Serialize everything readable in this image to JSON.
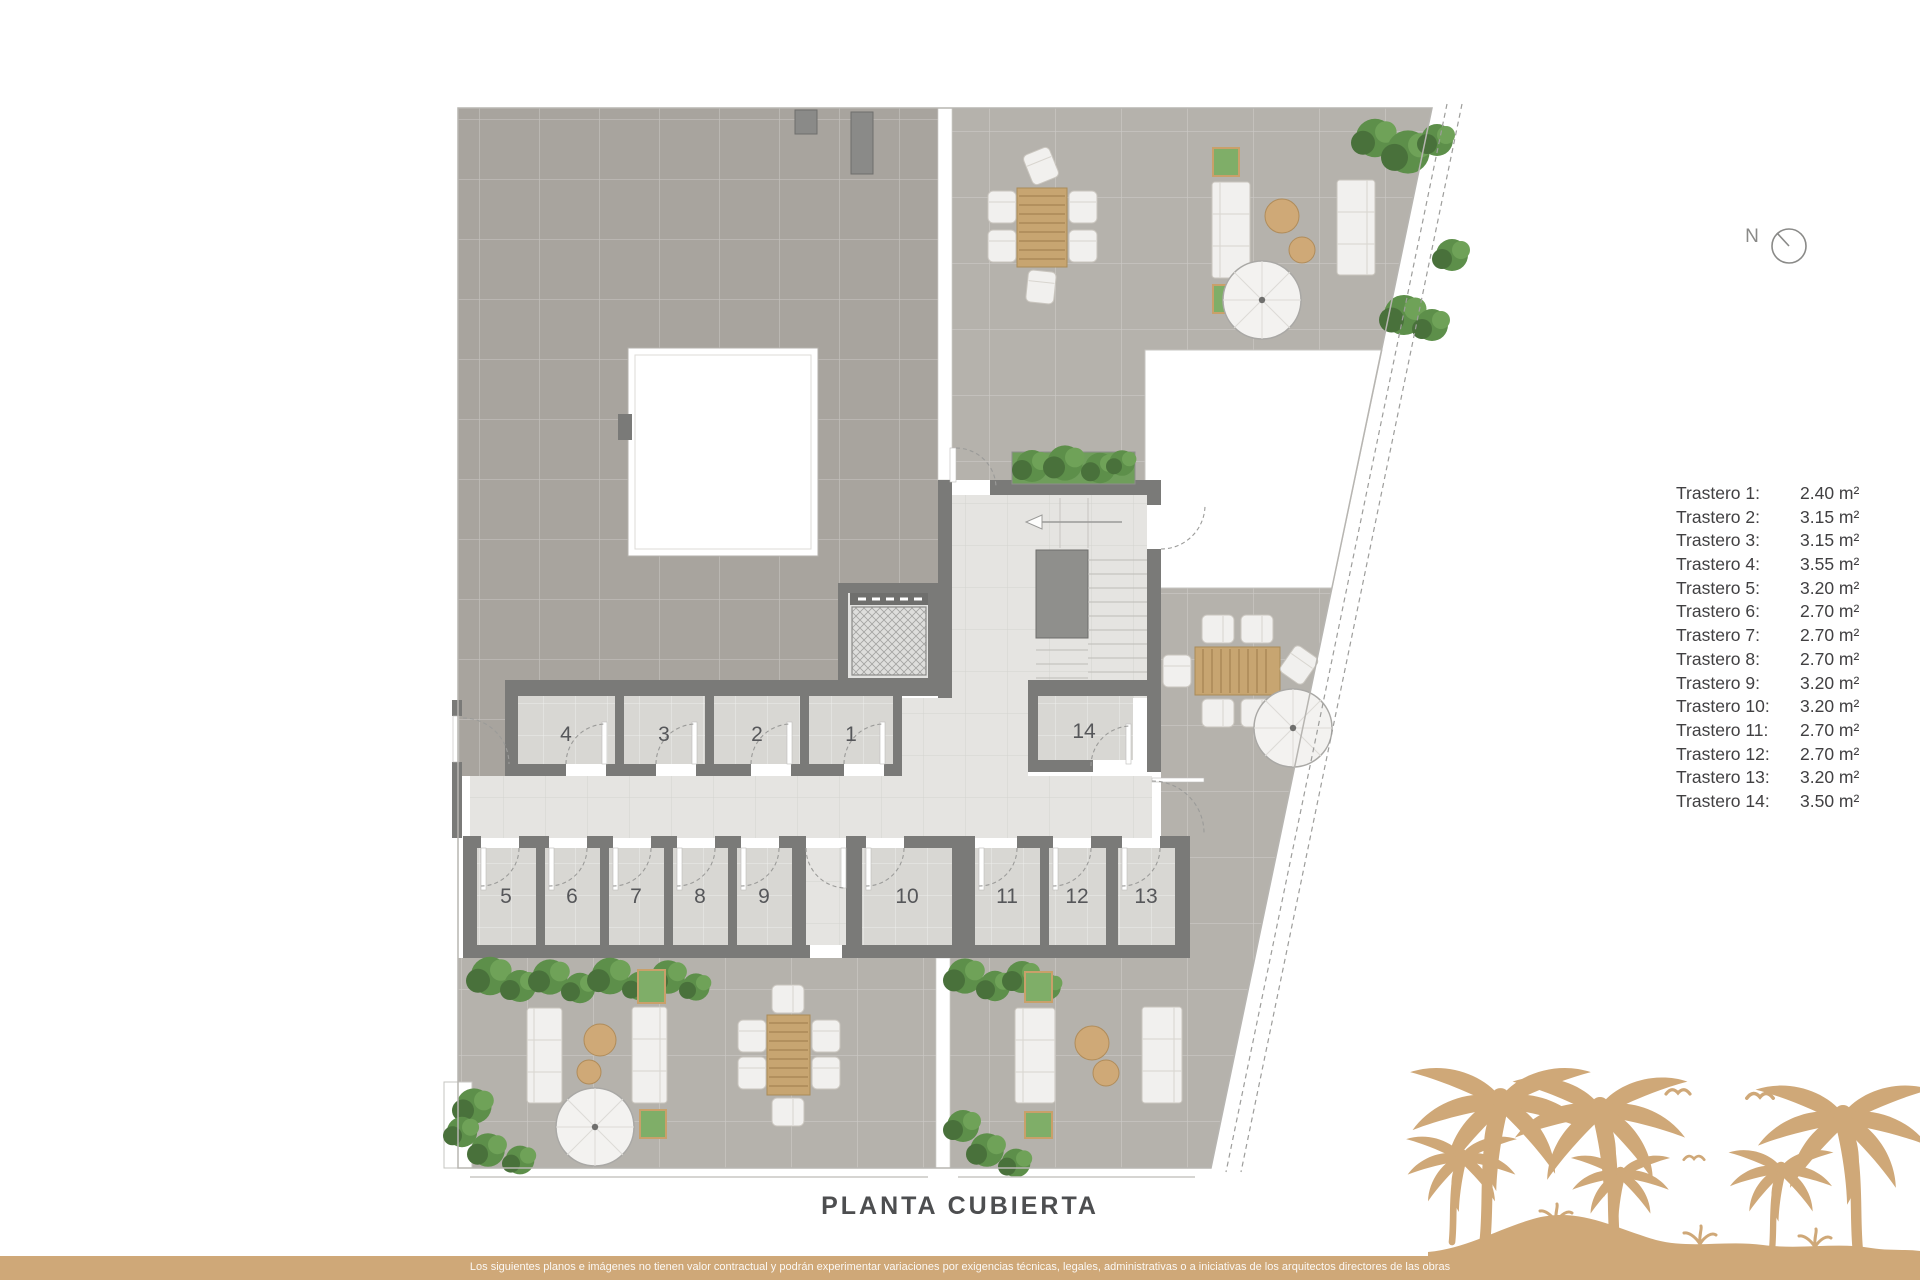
{
  "title": "PLANTA CUBIERTA",
  "compass": {
    "label": "N"
  },
  "legend": {
    "items": [
      {
        "label": "Trastero 1:",
        "value": "2.40 m²"
      },
      {
        "label": "Trastero 2:",
        "value": "3.15 m²"
      },
      {
        "label": "Trastero 3:",
        "value": "3.15 m²"
      },
      {
        "label": "Trastero 4:",
        "value": "3.55 m²"
      },
      {
        "label": "Trastero 5:",
        "value": "3.20 m²"
      },
      {
        "label": "Trastero 6:",
        "value": "2.70 m²"
      },
      {
        "label": "Trastero 7:",
        "value": "2.70 m²"
      },
      {
        "label": "Trastero 8:",
        "value": "2.70 m²"
      },
      {
        "label": "Trastero 9:",
        "value": "3.20 m²"
      },
      {
        "label": "Trastero 10:",
        "value": "3.20 m²"
      },
      {
        "label": "Trastero 11:",
        "value": "2.70 m²"
      },
      {
        "label": "Trastero 12:",
        "value": "2.70 m²"
      },
      {
        "label": "Trastero 13:",
        "value": "3.20 m²"
      },
      {
        "label": "Trastero 14:",
        "value": "3.50 m²"
      }
    ]
  },
  "plan": {
    "name": "PLANTA CUBIERTA",
    "rooms": [
      "1",
      "2",
      "3",
      "4",
      "5",
      "6",
      "7",
      "8",
      "9",
      "10",
      "11",
      "12",
      "13",
      "14"
    ]
  },
  "footer": {
    "disclaimer": "Los siguientes planos e imágenes no tienen valor contractual y podrán experimentar variaciones por exigencias técnicas, legales, administrativas o a iniciativas de los arquitectos directores de las obras"
  },
  "colors": {
    "accent": "#cfa878",
    "wall": "#7a7a78",
    "terrace-dark": "#a8a49e",
    "terrace-light": "#b5b2ac",
    "floor-light": "#e5e4e1",
    "room-floor": "#d8d7d3",
    "green": "#5d8f4a",
    "wood": "#c7a571",
    "text-dark": "#414042",
    "title-color": "#4d4e50"
  }
}
